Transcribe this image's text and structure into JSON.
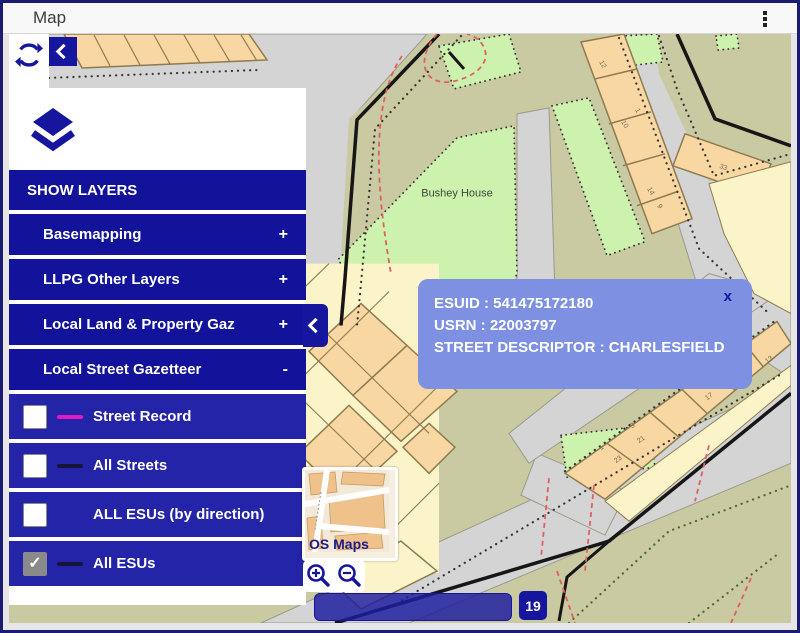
{
  "window": {
    "title": "Map"
  },
  "toolbar": {
    "refresh_icon": "refresh-icon",
    "collapse_icon": "chevron-left-icon"
  },
  "layers_panel": {
    "panel_icon": "layers-icon",
    "header": "SHOW LAYERS",
    "checkmark": "✓",
    "groups": [
      {
        "label": "Basemapping",
        "state": "+"
      },
      {
        "label": "LLPG Other Layers",
        "state": "+"
      },
      {
        "label": "Local Land & Property Gaz",
        "state": "+"
      },
      {
        "label": "Local Street Gazetteer",
        "state": "-"
      }
    ],
    "layers": [
      {
        "label": "Street Record",
        "checked": false,
        "swatch_color": "#e018c8"
      },
      {
        "label": "All Streets",
        "checked": false,
        "swatch_color": "#15153a"
      },
      {
        "label": "ALL ESUs (by direction)",
        "checked": false,
        "swatch_color": ""
      },
      {
        "label": "All ESUs",
        "checked": true,
        "swatch_color": "#15153a"
      }
    ]
  },
  "map": {
    "place_label": "Bushey House",
    "house_numbers": [
      "12",
      "10",
      "1",
      "14",
      "9",
      "33",
      "1",
      "3",
      "21",
      "23",
      "17",
      "13"
    ],
    "popup": {
      "lines": [
        "ESUID : 541475172180",
        "USRN : 22003797",
        "STREET DESCRIPTOR : CHARLESFIELD"
      ],
      "close_label": "x"
    },
    "minimap_label": "OS Maps",
    "zoom_level": "19"
  },
  "colors": {
    "panel_blue": "#12129a",
    "row_blue": "#2424a8",
    "accent_navy": "#15159e",
    "popup_blue": "#7d90e2",
    "swatch_magenta": "#e018c8",
    "swatch_black": "#15153a",
    "map_khaki": "#c9c9a2",
    "map_road": "#d4d4d4",
    "map_green": "#cdf2ad",
    "map_orange": "#f9d7a3",
    "map_cream": "#fcf4c9"
  }
}
